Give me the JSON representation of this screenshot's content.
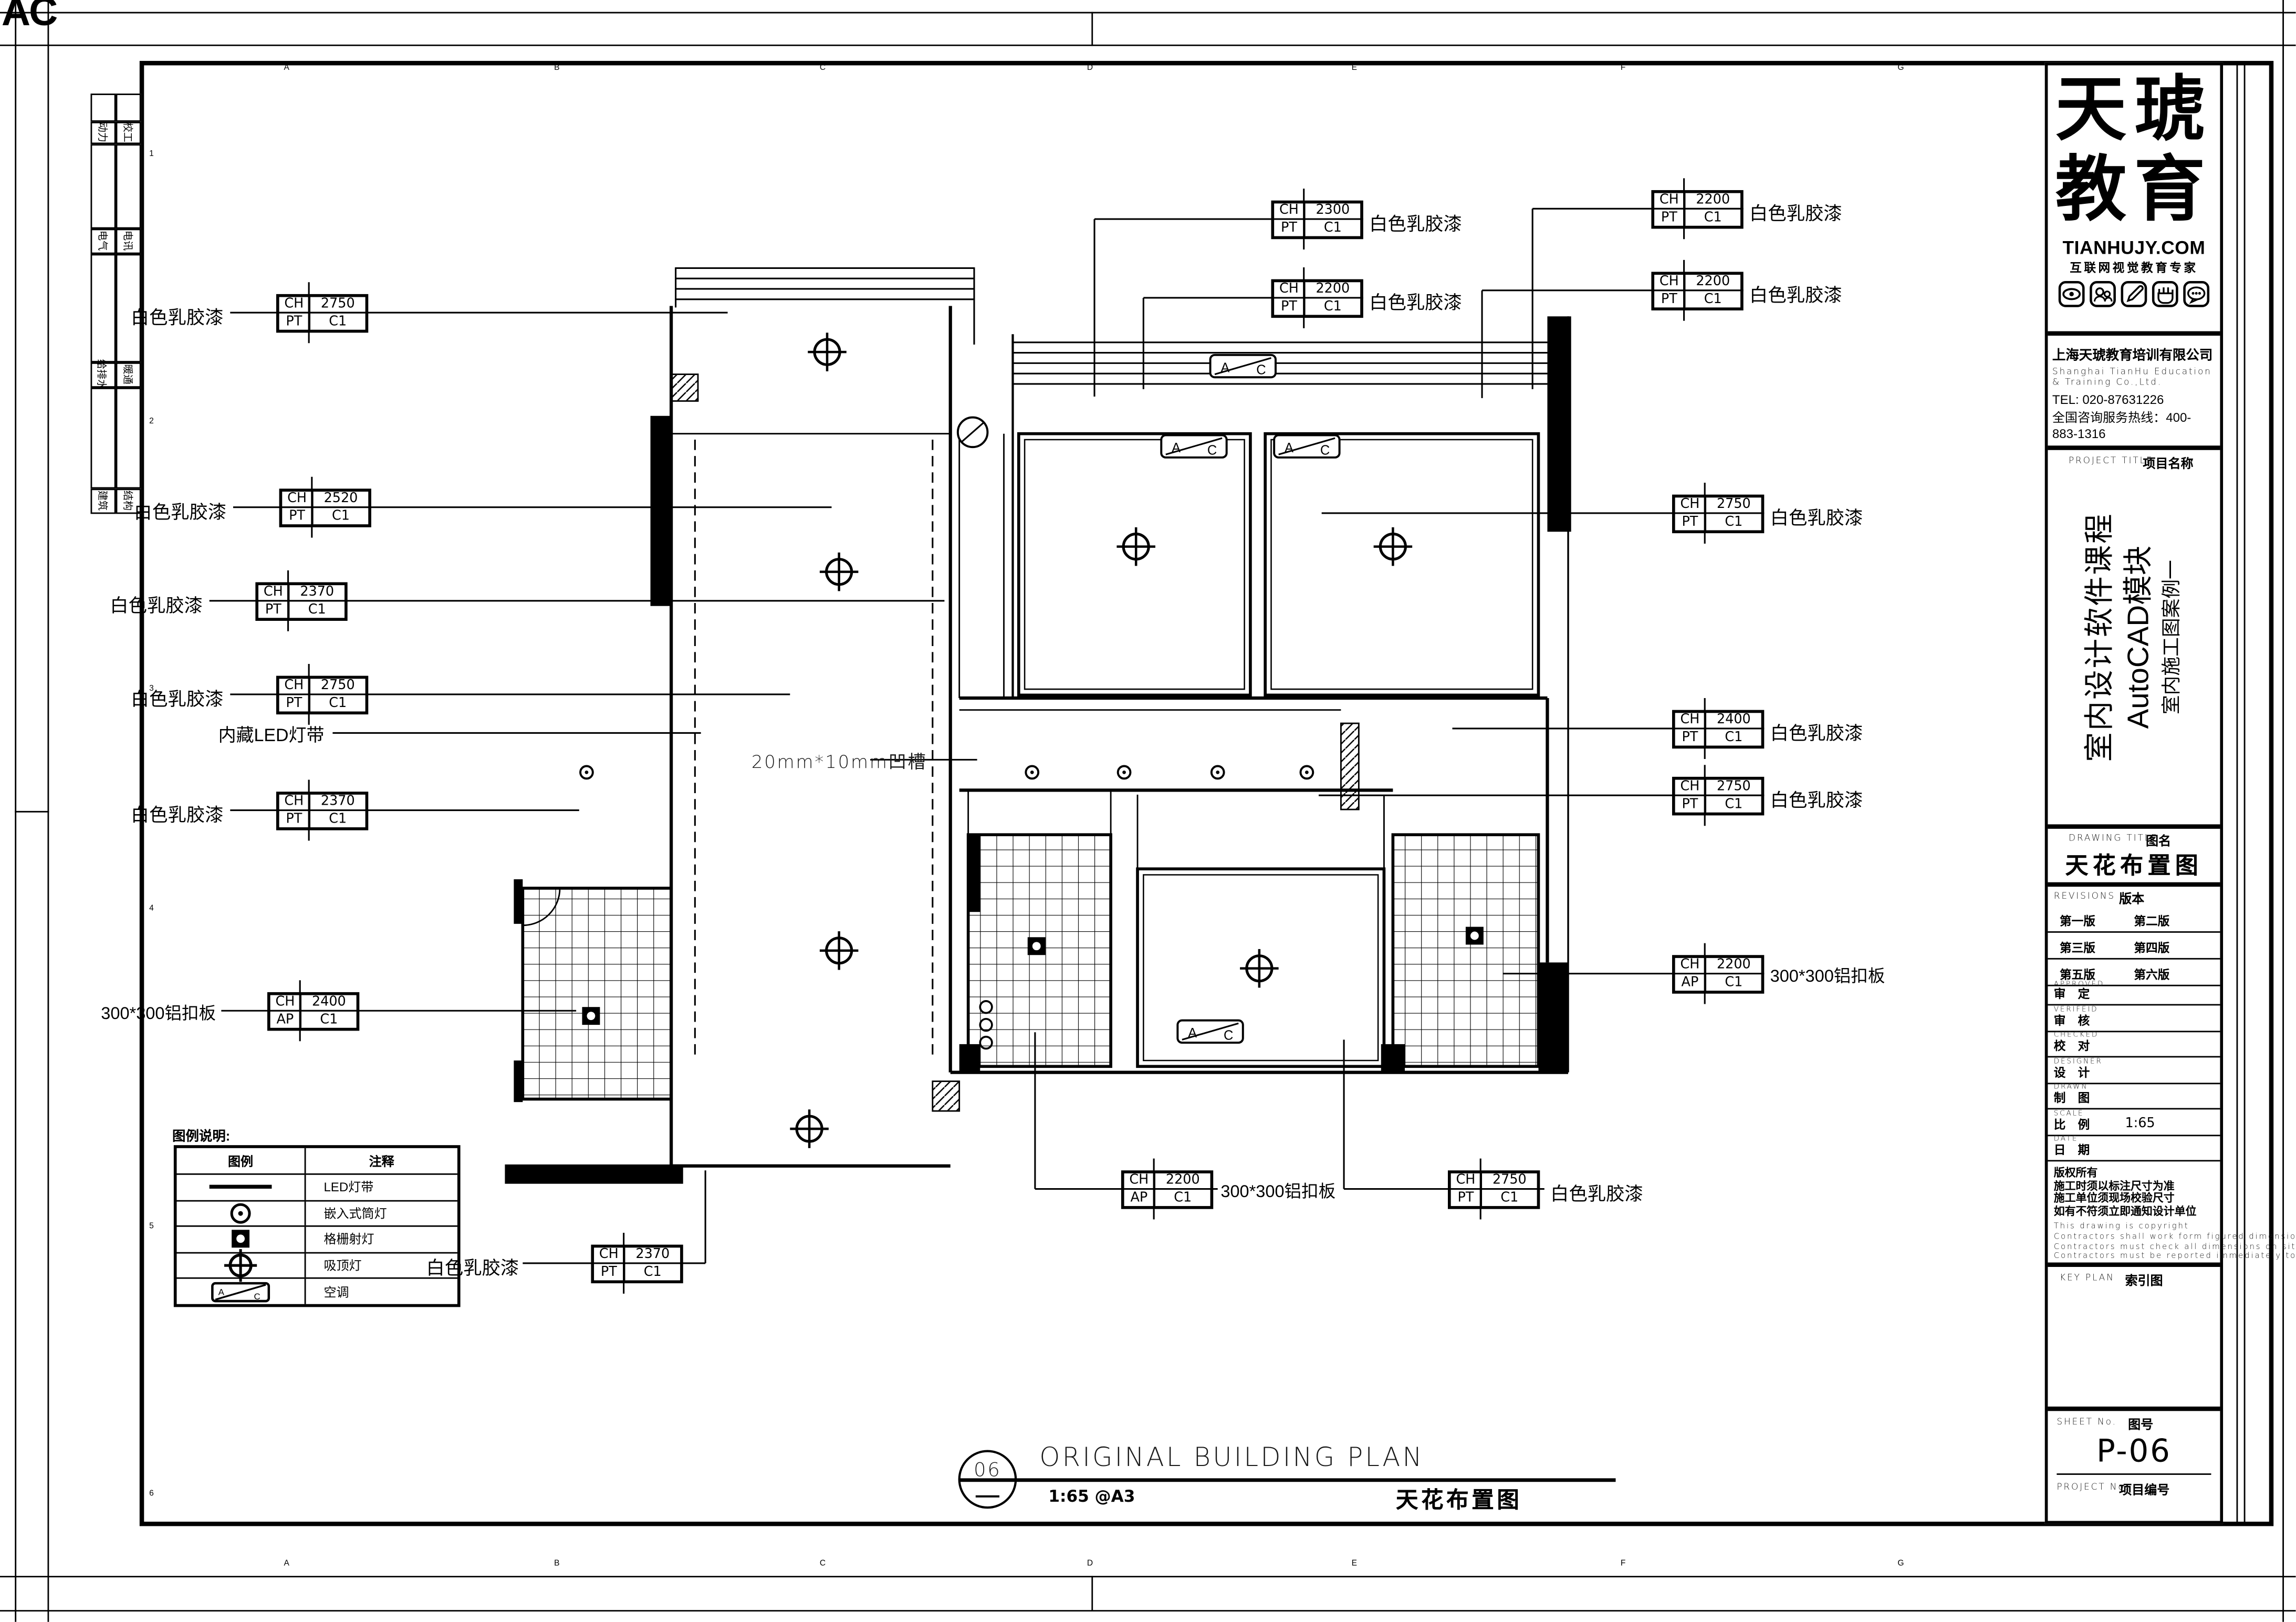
{
  "sheet": {
    "corner_mark": "AC",
    "grid_letters_top": [
      "A",
      "B",
      "C",
      "D",
      "E",
      "F",
      "G"
    ],
    "grid_letters_bottom": [
      "A",
      "B",
      "C",
      "D",
      "E",
      "F",
      "G"
    ],
    "grid_numbers_left": [
      "1",
      "2",
      "3",
      "4",
      "5",
      "6"
    ]
  },
  "strip": {
    "rows": [
      {
        "left": "动力",
        "right": "校工"
      },
      {
        "left": "电气",
        "right": "电讯"
      },
      {
        "left": "给排水",
        "right": "暖通"
      },
      {
        "left": "建筑",
        "right": "结构"
      }
    ]
  },
  "plan": {
    "ac_a": "A",
    "ac_c": "C",
    "groove_note": "20mm*10mm凹槽",
    "led_note": "内藏LED灯带",
    "labels": [
      {
        "finish": "白色乳胶漆",
        "k1": "CH",
        "v1": "2750",
        "k2": "PT",
        "v2": "C1"
      },
      {
        "finish": "白色乳胶漆",
        "k1": "CH",
        "v1": "2520",
        "k2": "PT",
        "v2": "C1"
      },
      {
        "finish": "白色乳胶漆",
        "k1": "CH",
        "v1": "2370",
        "k2": "PT",
        "v2": "C1"
      },
      {
        "finish": "白色乳胶漆",
        "k1": "CH",
        "v1": "2750",
        "k2": "PT",
        "v2": "C1"
      },
      {
        "finish": "白色乳胶漆",
        "k1": "CH",
        "v1": "2370",
        "k2": "PT",
        "v2": "C1"
      },
      {
        "finish": "300*300铝扣板",
        "k1": "CH",
        "v1": "2400",
        "k2": "AP",
        "v2": "C1"
      },
      {
        "finish": "白色乳胶漆",
        "k1": "CH",
        "v1": "2370",
        "k2": "PT",
        "v2": "C1"
      },
      {
        "finish": "白色乳胶漆",
        "k1": "CH",
        "v1": "2300",
        "k2": "PT",
        "v2": "C1"
      },
      {
        "finish": "白色乳胶漆",
        "k1": "CH",
        "v1": "2200",
        "k2": "PT",
        "v2": "C1"
      },
      {
        "finish": "白色乳胶漆",
        "k1": "CH",
        "v1": "2200",
        "k2": "PT",
        "v2": "C1"
      },
      {
        "finish": "白色乳胶漆",
        "k1": "CH",
        "v1": "2200",
        "k2": "PT",
        "v2": "C1"
      },
      {
        "finish": "白色乳胶漆",
        "k1": "CH",
        "v1": "2750",
        "k2": "PT",
        "v2": "C1"
      },
      {
        "finish": "白色乳胶漆",
        "k1": "CH",
        "v1": "2400",
        "k2": "PT",
        "v2": "C1"
      },
      {
        "finish": "白色乳胶漆",
        "k1": "CH",
        "v1": "2750",
        "k2": "PT",
        "v2": "C1"
      },
      {
        "finish": "300*300铝扣板",
        "k1": "CH",
        "v1": "2200",
        "k2": "AP",
        "v2": "C1"
      },
      {
        "finish": "300*300铝扣板",
        "k1": "CH",
        "v1": "2200",
        "k2": "AP",
        "v2": "C1"
      },
      {
        "finish": "白色乳胶漆",
        "k1": "CH",
        "v1": "2750",
        "k2": "PT",
        "v2": "C1"
      }
    ]
  },
  "legend": {
    "title": "图例说明:",
    "col_symbol": "图例",
    "col_desc": "注释",
    "rows": [
      {
        "symbol": "led-strip-line",
        "desc": "LED灯带"
      },
      {
        "symbol": "recessed-downlight",
        "desc": "嵌入式筒灯"
      },
      {
        "symbol": "grille-spotlight",
        "desc": "格栅射灯"
      },
      {
        "symbol": "ceiling-lamp",
        "desc": "吸顶灯"
      },
      {
        "symbol": "air-conditioner",
        "desc": "空调"
      }
    ]
  },
  "view_title": {
    "number": "06",
    "name": "ORIGINAL BUILDING PLAN",
    "scale": "1:65  @A3",
    "cn": "天花布置图"
  },
  "titleblock": {
    "logo": {
      "word1": "天琥",
      "word2": "教育",
      "site": "TIANHUJY.COM",
      "tagline": "互联网视觉教育专家"
    },
    "company": {
      "name_cn": "上海天琥教育培训有限公司",
      "name_en": "Shanghai TianHu Education & Training Co.,Ltd.",
      "tel": "TEL: 020-87631226",
      "hotline": "全国咨询服务热线：400-883-1316"
    },
    "project": {
      "en": "PROJECT TITLE",
      "cn": "项目名称",
      "line1": "室内设计软件课程",
      "line2": "AutoCAD模块",
      "line3": "室内施工图案例一"
    },
    "drawing": {
      "en": "DRAWING TITLE",
      "cn": "图名",
      "value": "天花布置图"
    },
    "revisions": {
      "en": "REVISIONS",
      "cn": "版本",
      "r1": "第一版",
      "r2": "第二版",
      "r3": "第三版",
      "r4": "第四版",
      "r5": "第五版",
      "r6": "第六版"
    },
    "signs": [
      {
        "en": "APPROVED",
        "cn": "审 定",
        "value": ""
      },
      {
        "en": "VERIFEID",
        "cn": "审 核",
        "value": ""
      },
      {
        "en": "CHECKED",
        "cn": "校 对",
        "value": ""
      },
      {
        "en": "DESIGNER",
        "cn": "设 计",
        "value": ""
      },
      {
        "en": "DRAWN",
        "cn": "制 图",
        "value": ""
      },
      {
        "en": "SCALE",
        "cn": "比 例",
        "value": "1:65"
      },
      {
        "en": "DATE",
        "cn": "日 期",
        "value": ""
      }
    ],
    "notes_cn": [
      "版权所有",
      "施工时须以标注尺寸为准",
      "施工单位须现场校验尺寸",
      "如有不符须立即通知设计单位"
    ],
    "notes_en": [
      "This drawing is copyright",
      "Contractors shall work form figured dimensions only",
      "Contractors must check all dimensions on site",
      "Contractors must be reported immediately to architects"
    ],
    "keyplan": {
      "en": "KEY PLAN",
      "cn": "索引图"
    },
    "sheetno": {
      "en": "SHEET No.",
      "cn": "图号",
      "value": "P-06"
    },
    "projectno": {
      "en": "PROJECT No.",
      "cn": "项目编号",
      "value": ""
    }
  }
}
